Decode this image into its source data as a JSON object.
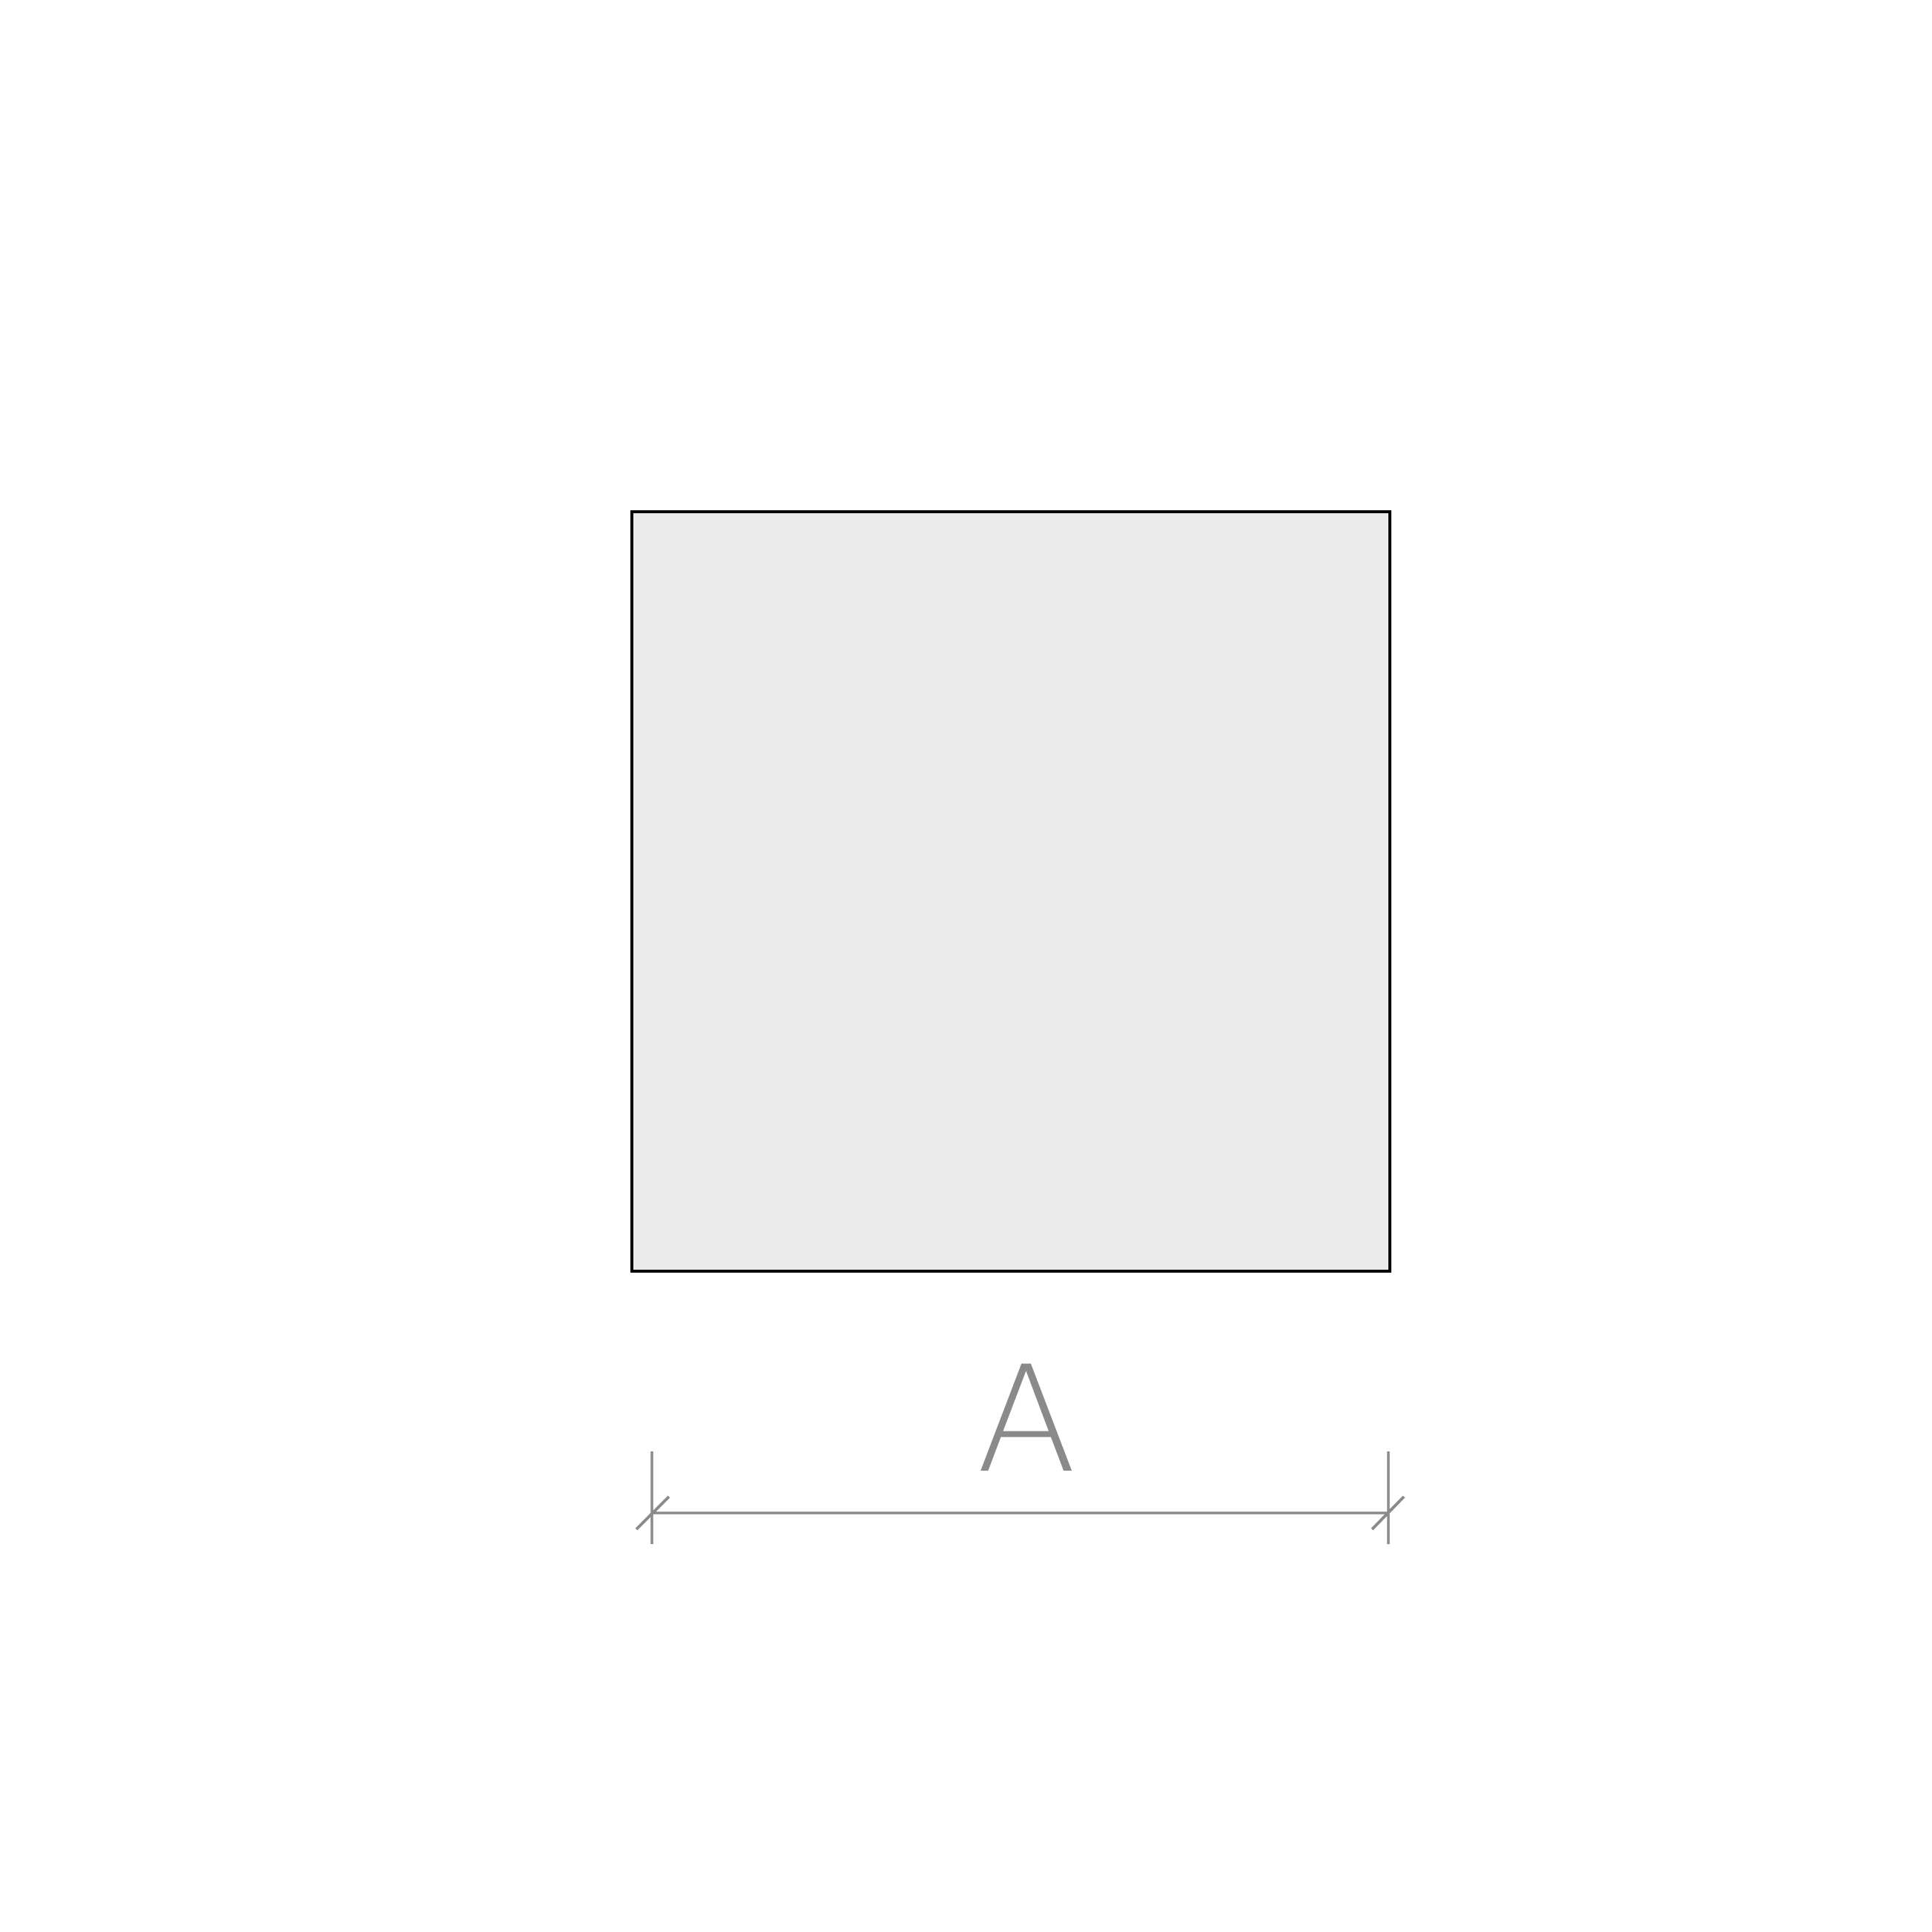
{
  "page": {
    "background": "#ffffff"
  },
  "diagram": {
    "shape": {
      "fill": "#ebebeb",
      "stroke": "#000000"
    },
    "dimension": {
      "label": "A",
      "color": "#8a8a8a"
    }
  }
}
